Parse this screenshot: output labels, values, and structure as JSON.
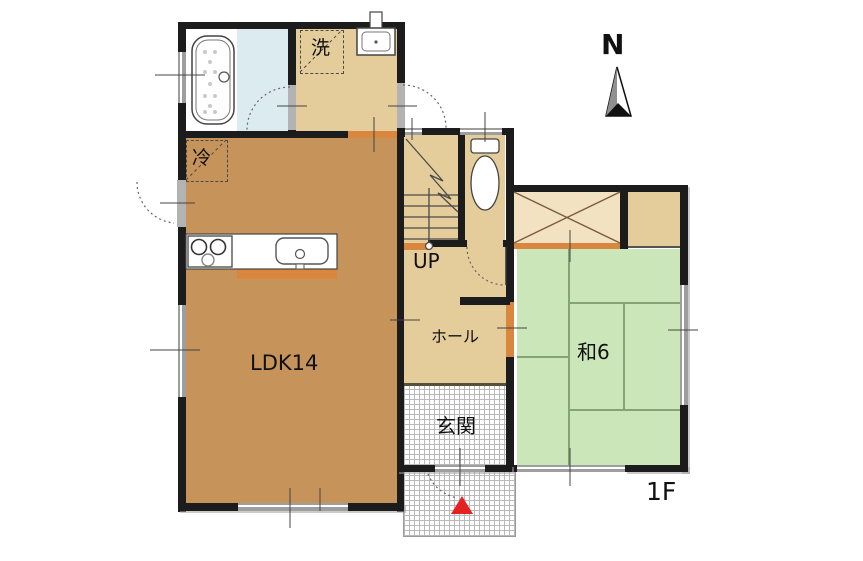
{
  "floorplan": {
    "floor_label": "1F",
    "compass_label": "N",
    "rooms": {
      "ldk": {
        "label": "LDK14"
      },
      "washroom": {
        "label": "洗"
      },
      "refrigerator_space": {
        "label": "冷"
      },
      "hall": {
        "label": "ホール"
      },
      "entrance": {
        "label": "玄関"
      },
      "japanese_room": {
        "label": "和6"
      },
      "stairs": {
        "label": "UP"
      }
    },
    "colors": {
      "wall": "#1c1c1c",
      "ldk_floor": "#c6935b",
      "corridor_floor": "#e5cc9b",
      "closet_floor": "#f2e2c2",
      "tatami_floor": "#cbe7ba",
      "bath_floor": "#dcebf0",
      "threshold_orange": "#d9863f",
      "window_gray": "#9e9e9e",
      "entrance_marker_red": "#e32222",
      "tatami_line": "#84a476"
    }
  }
}
